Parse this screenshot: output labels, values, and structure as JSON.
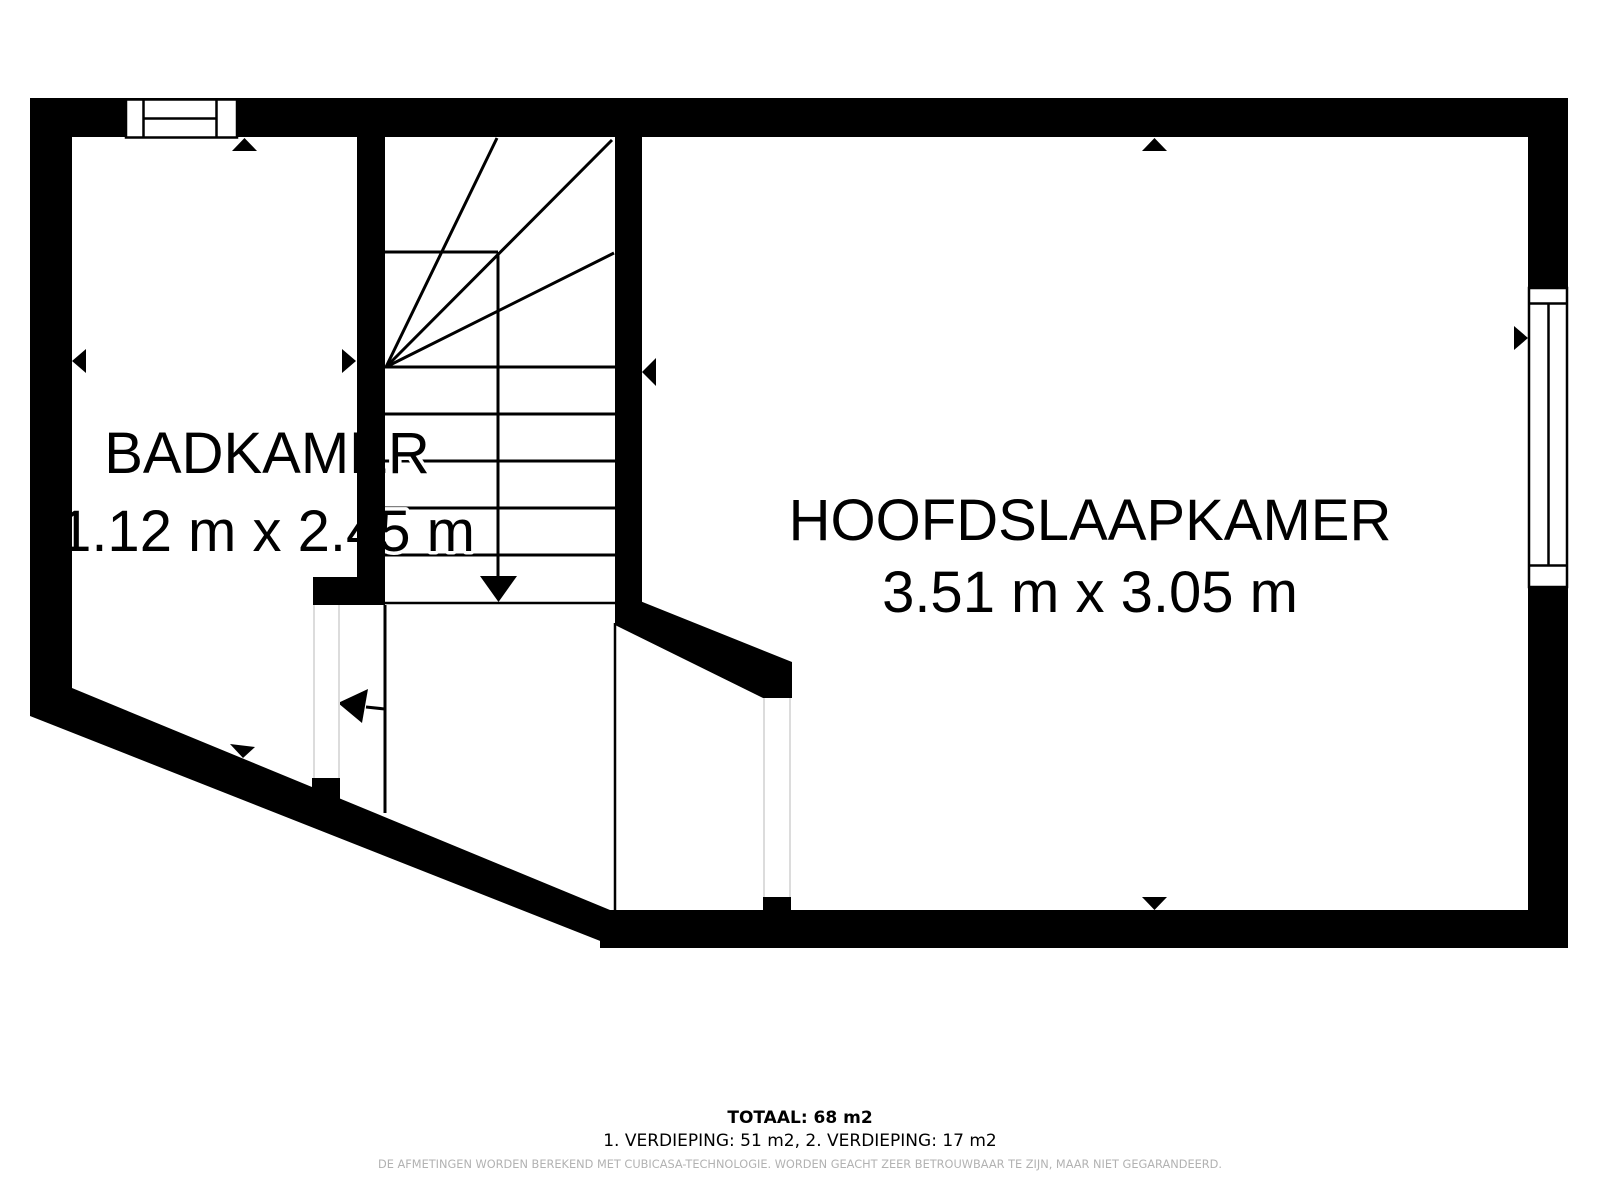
{
  "floorplan": {
    "rooms": [
      {
        "name": "BADKAMER",
        "dimensions": "1.12 m x 2.45 m"
      },
      {
        "name": "HOOFDSLAAPKAMER",
        "dimensions": "3.51 m x 3.05 m"
      }
    ],
    "summary_total": "TOTAAL: 68 m2",
    "summary_floors": "1. VERDIEPING: 51 m2, 2. VERDIEPING: 17 m2",
    "disclaimer": "DE AFMETINGEN WORDEN BEREKEND MET CUBICASA-TECHNOLOGIE. WORDEN GEACHT ZEER BETROUWBAAR TE ZIJN, MAAR NIET GEGARANDEERD.",
    "colors": {
      "wall": "#000000",
      "background": "#ffffff",
      "disclaimer": "#b2b2b2"
    }
  }
}
